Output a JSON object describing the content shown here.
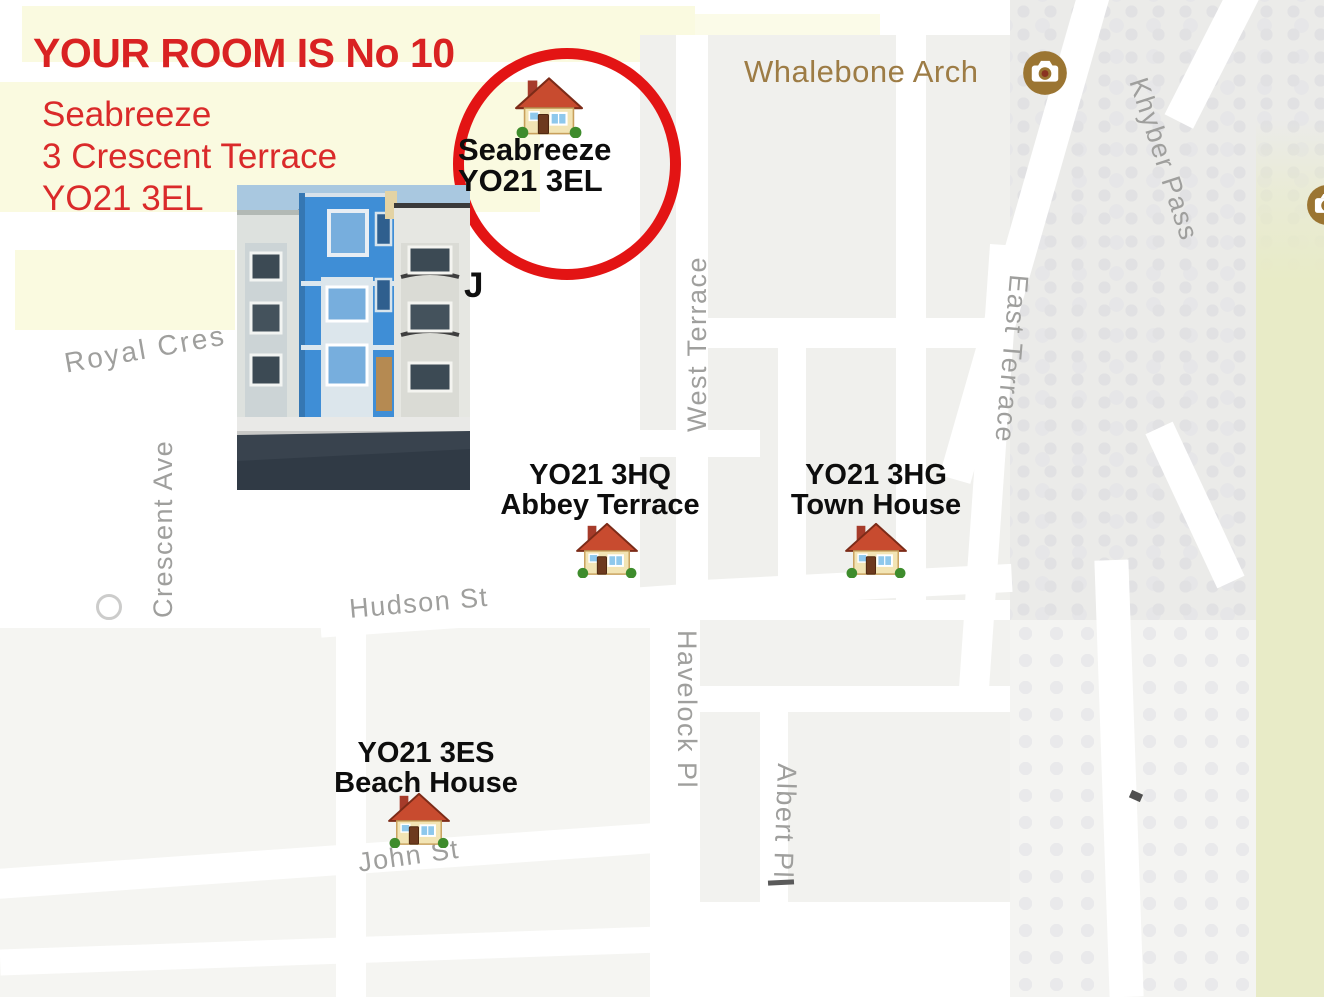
{
  "annotations": {
    "heading": "YOUR ROOM IS No 10",
    "address_lines": "Seabreeze\n3 Crescent Terrace\nYO21 3EL",
    "partial_label": "J"
  },
  "markers": [
    {
      "id": "seabreeze",
      "line1": "Seabreeze",
      "line2": "YO21 3EL"
    },
    {
      "id": "abbey",
      "line1": "YO21 3HQ",
      "line2": "Abbey Terrace"
    },
    {
      "id": "town",
      "line1": "YO21 3HG",
      "line2": "Town House"
    },
    {
      "id": "beach",
      "line1": "YO21 3ES",
      "line2": "Beach House"
    }
  ],
  "poi": {
    "whalebone_arch": "Whalebone Arch"
  },
  "streets": [
    {
      "id": "royal-cres",
      "label": "Royal Cres"
    },
    {
      "id": "crescent-ave",
      "label": "Crescent Ave"
    },
    {
      "id": "west-terrace",
      "label": "West Terrace"
    },
    {
      "id": "east-terrace",
      "label": "East Terrace"
    },
    {
      "id": "khyber-pass",
      "label": "Khyber Pass"
    },
    {
      "id": "hudson-st",
      "label": "Hudson St"
    },
    {
      "id": "havelock-pl",
      "label": "Havelock Pl"
    },
    {
      "id": "albert-pl",
      "label": "Albert Pl"
    },
    {
      "id": "john-st",
      "label": "John St"
    }
  ],
  "colors": {
    "instruction_red": "#d92222",
    "circle_red": "#e31414",
    "marker_text": "#0d0d0d",
    "poi_brown": "#9d7c45",
    "street_gray": "#9f9f9d",
    "landuse_cream": "#fafae0",
    "terrain_green": "#e8ebc7",
    "photo_building_blue": "#3f8ed6"
  }
}
